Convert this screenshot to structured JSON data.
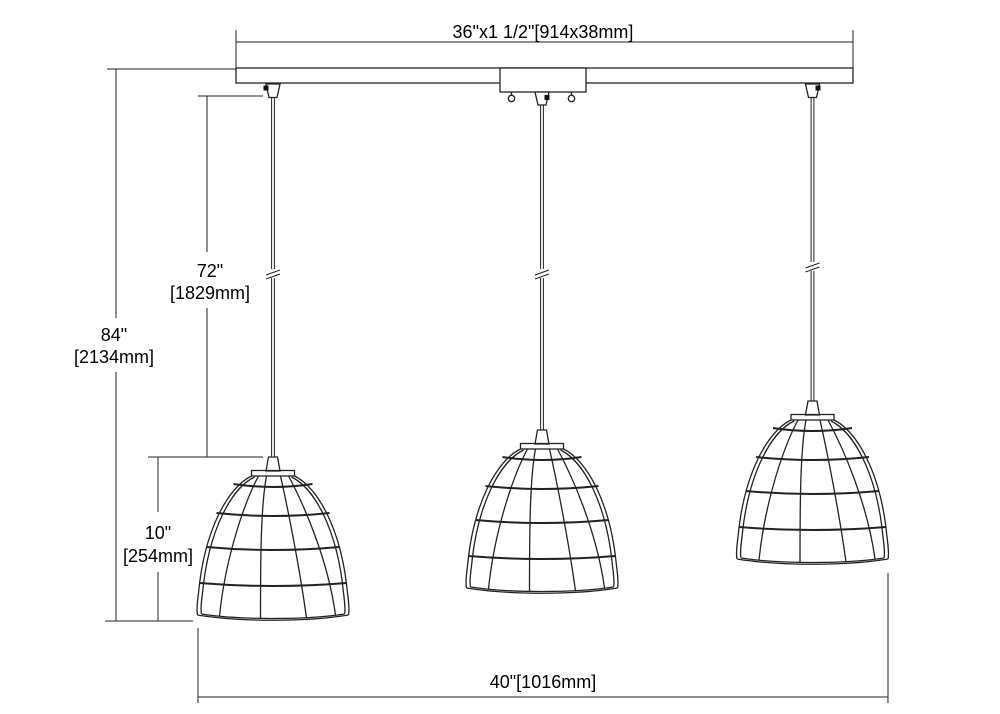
{
  "drawing": {
    "labels": {
      "bar_width": "36\"x1 1/2\"[914x38mm]",
      "overall_height_in": "84\"",
      "overall_height_mm": "[2134mm]",
      "cord_length_in": "72\"",
      "cord_length_mm": "[1829mm]",
      "shade_height_in": "10\"",
      "shade_height_mm": "[254mm]",
      "overall_width": "40\"[1016mm]"
    },
    "colors": {
      "line": "#222222",
      "text": "#000000",
      "background": "#ffffff"
    }
  }
}
